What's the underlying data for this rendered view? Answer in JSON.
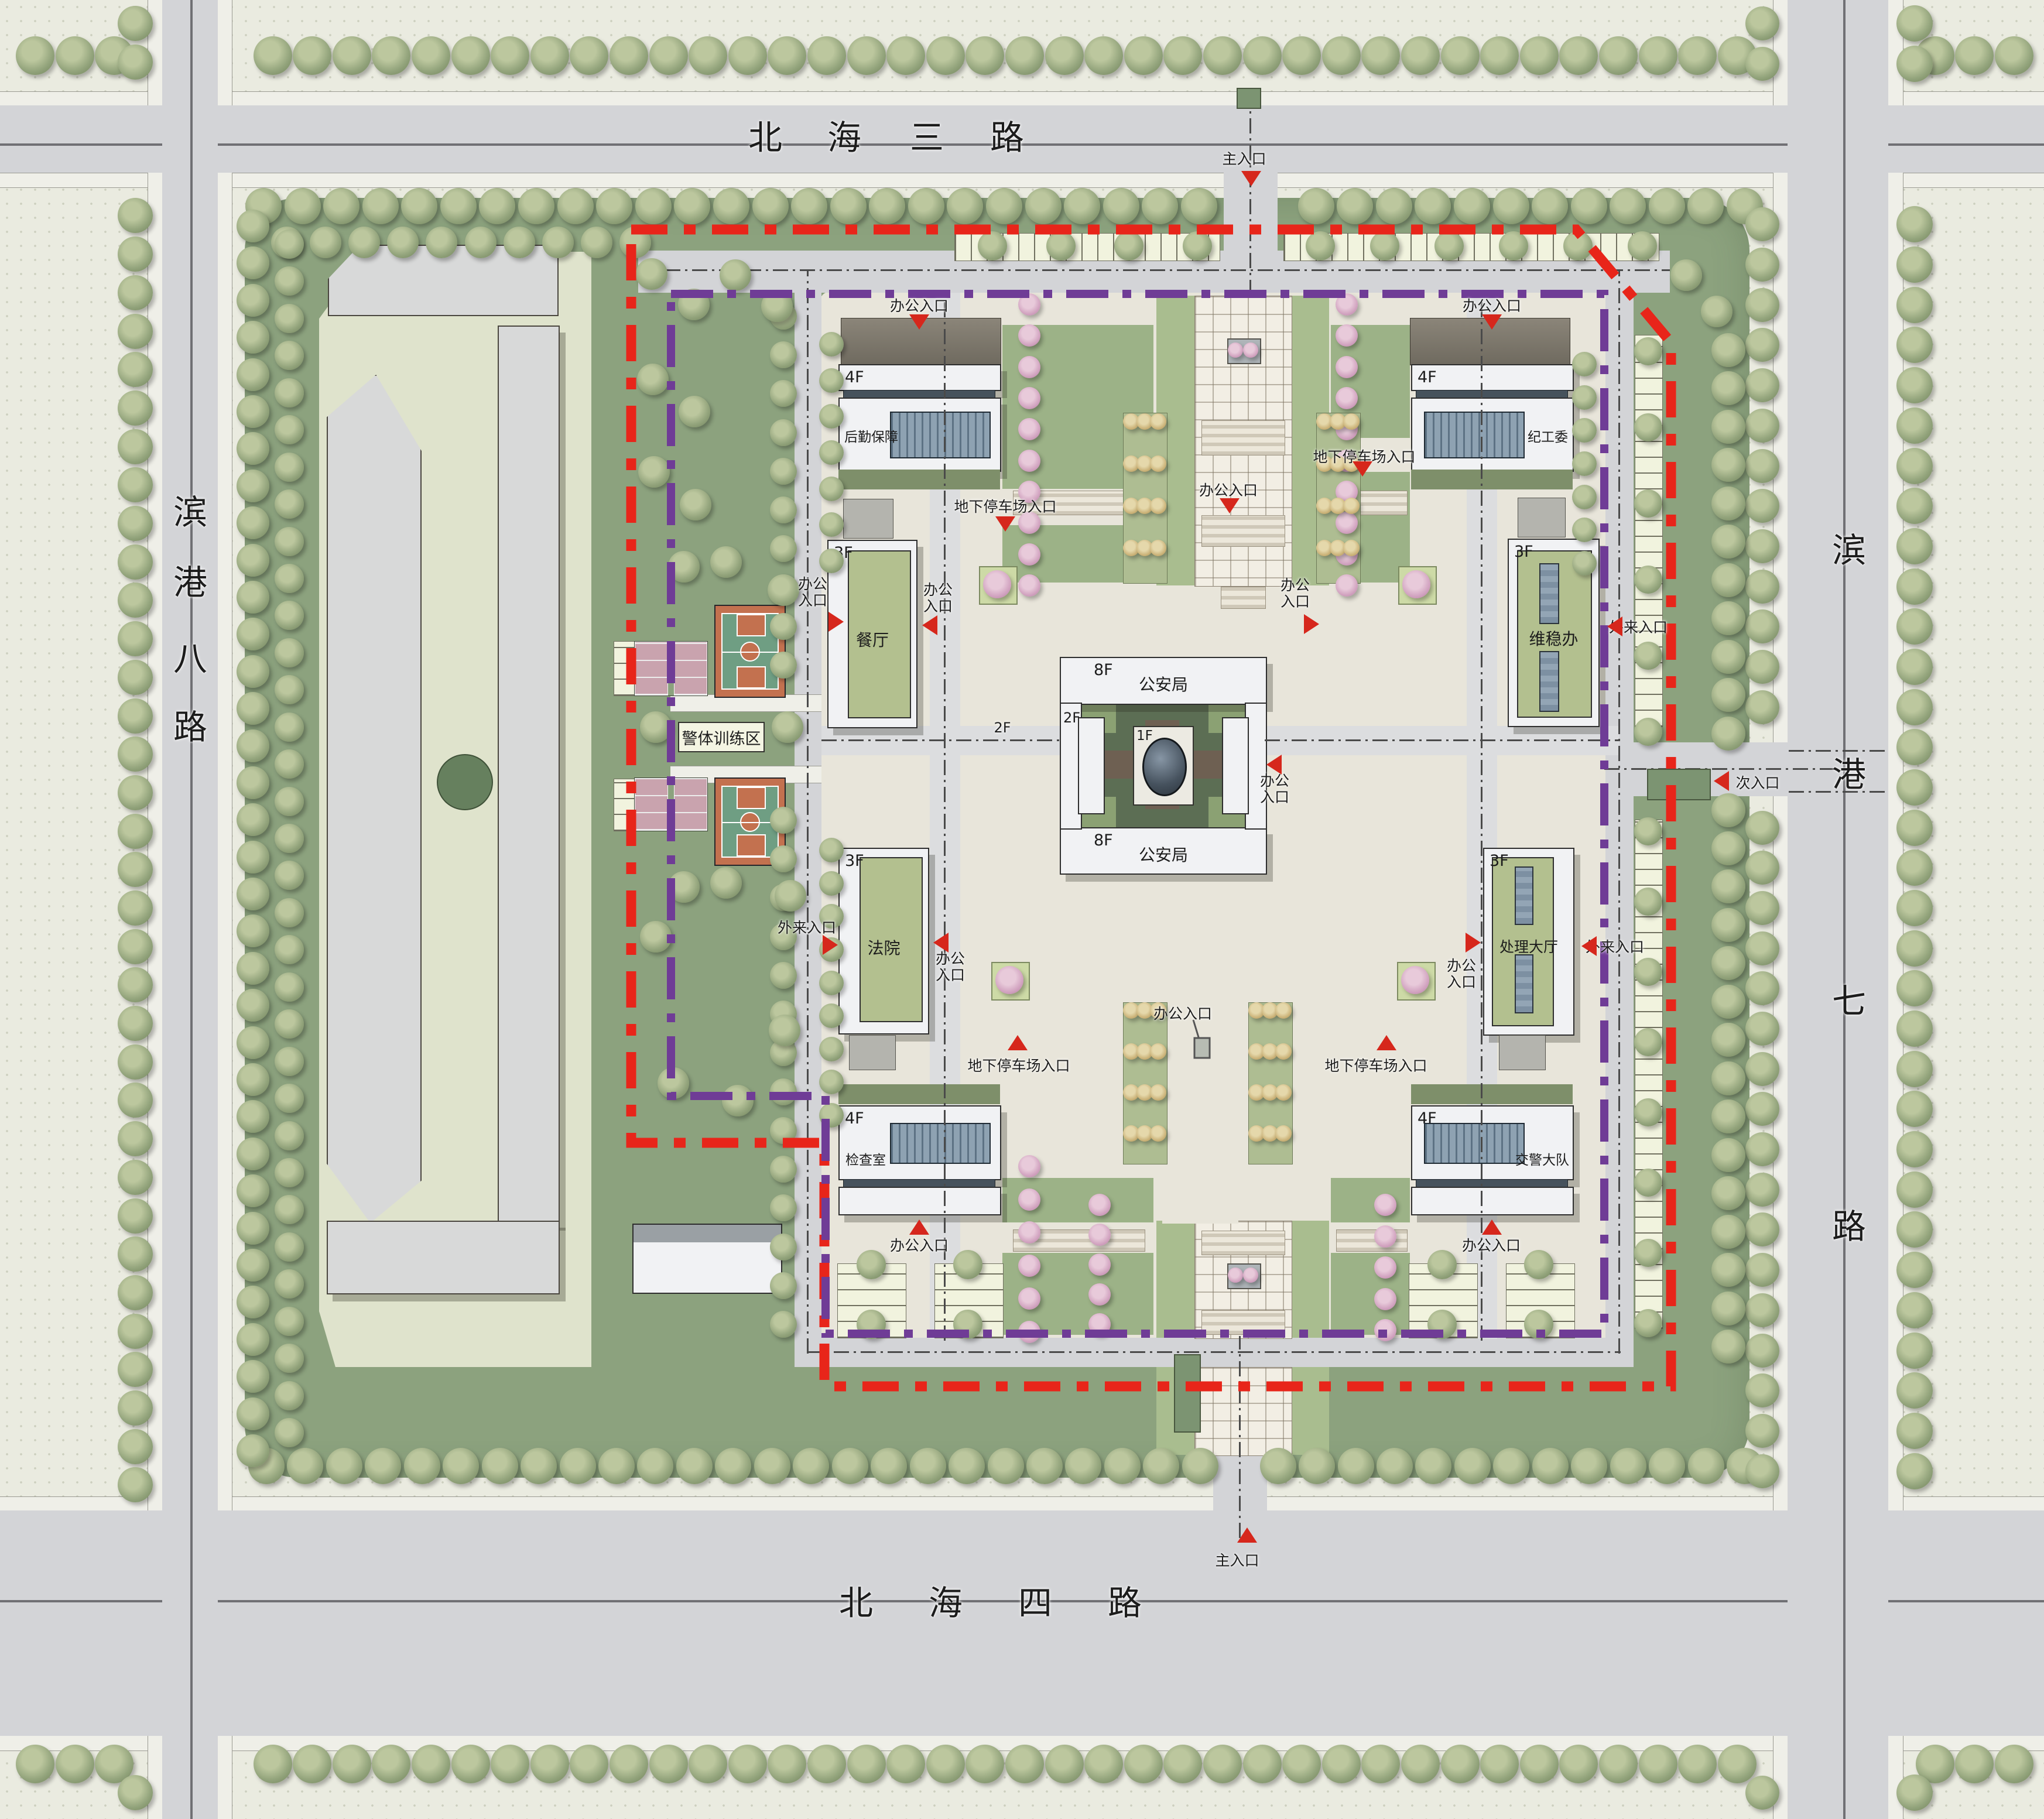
{
  "roads": {
    "north": {
      "name": "北海三路",
      "chars": [
        "北",
        "海",
        "三",
        "路"
      ]
    },
    "south": {
      "name": "北海四路",
      "chars": [
        "北",
        "海",
        "四",
        "路"
      ]
    },
    "west": {
      "name": "滨港八路",
      "chars": [
        "滨",
        "港",
        "八",
        "路"
      ]
    },
    "east": {
      "name": "滨港七路",
      "chars": [
        "滨",
        "港",
        "七",
        "路"
      ]
    }
  },
  "entrances": {
    "main": "主入口",
    "secondary": "次入口",
    "office": "办公入口",
    "visitor": "外来入口",
    "underground_parking": "地下停车场入口"
  },
  "buildings": [
    {
      "name": "后勤保障",
      "floors": "4F"
    },
    {
      "name": "纪工委",
      "floors": "4F"
    },
    {
      "name": "餐厅",
      "floors": "3F"
    },
    {
      "name": "维稳办",
      "floors": "3F"
    },
    {
      "name": "法院",
      "floors": "3F"
    },
    {
      "name": "处理大厅",
      "floors": "3F"
    },
    {
      "name": "检查室",
      "floors": "4F"
    },
    {
      "name": "交警大队",
      "floors": "4F"
    },
    {
      "name": "公安局",
      "floors": "8F"
    },
    {
      "name": "公安局",
      "floors": "8F"
    }
  ],
  "labels": {
    "training_area": "警体训练区",
    "floor_1f": "1F",
    "floor_2f": "2F"
  },
  "colors": {
    "boundary_red": "#e8251a",
    "boundary_purple": "#6f3c96",
    "marker_red": "#d6271c",
    "lawn_green": "#8ca27e",
    "green_roof": "#b3c08f",
    "court_orange": "#c3714f",
    "court_green": "#6f9e83",
    "court_pink": "#c9a3ae"
  }
}
